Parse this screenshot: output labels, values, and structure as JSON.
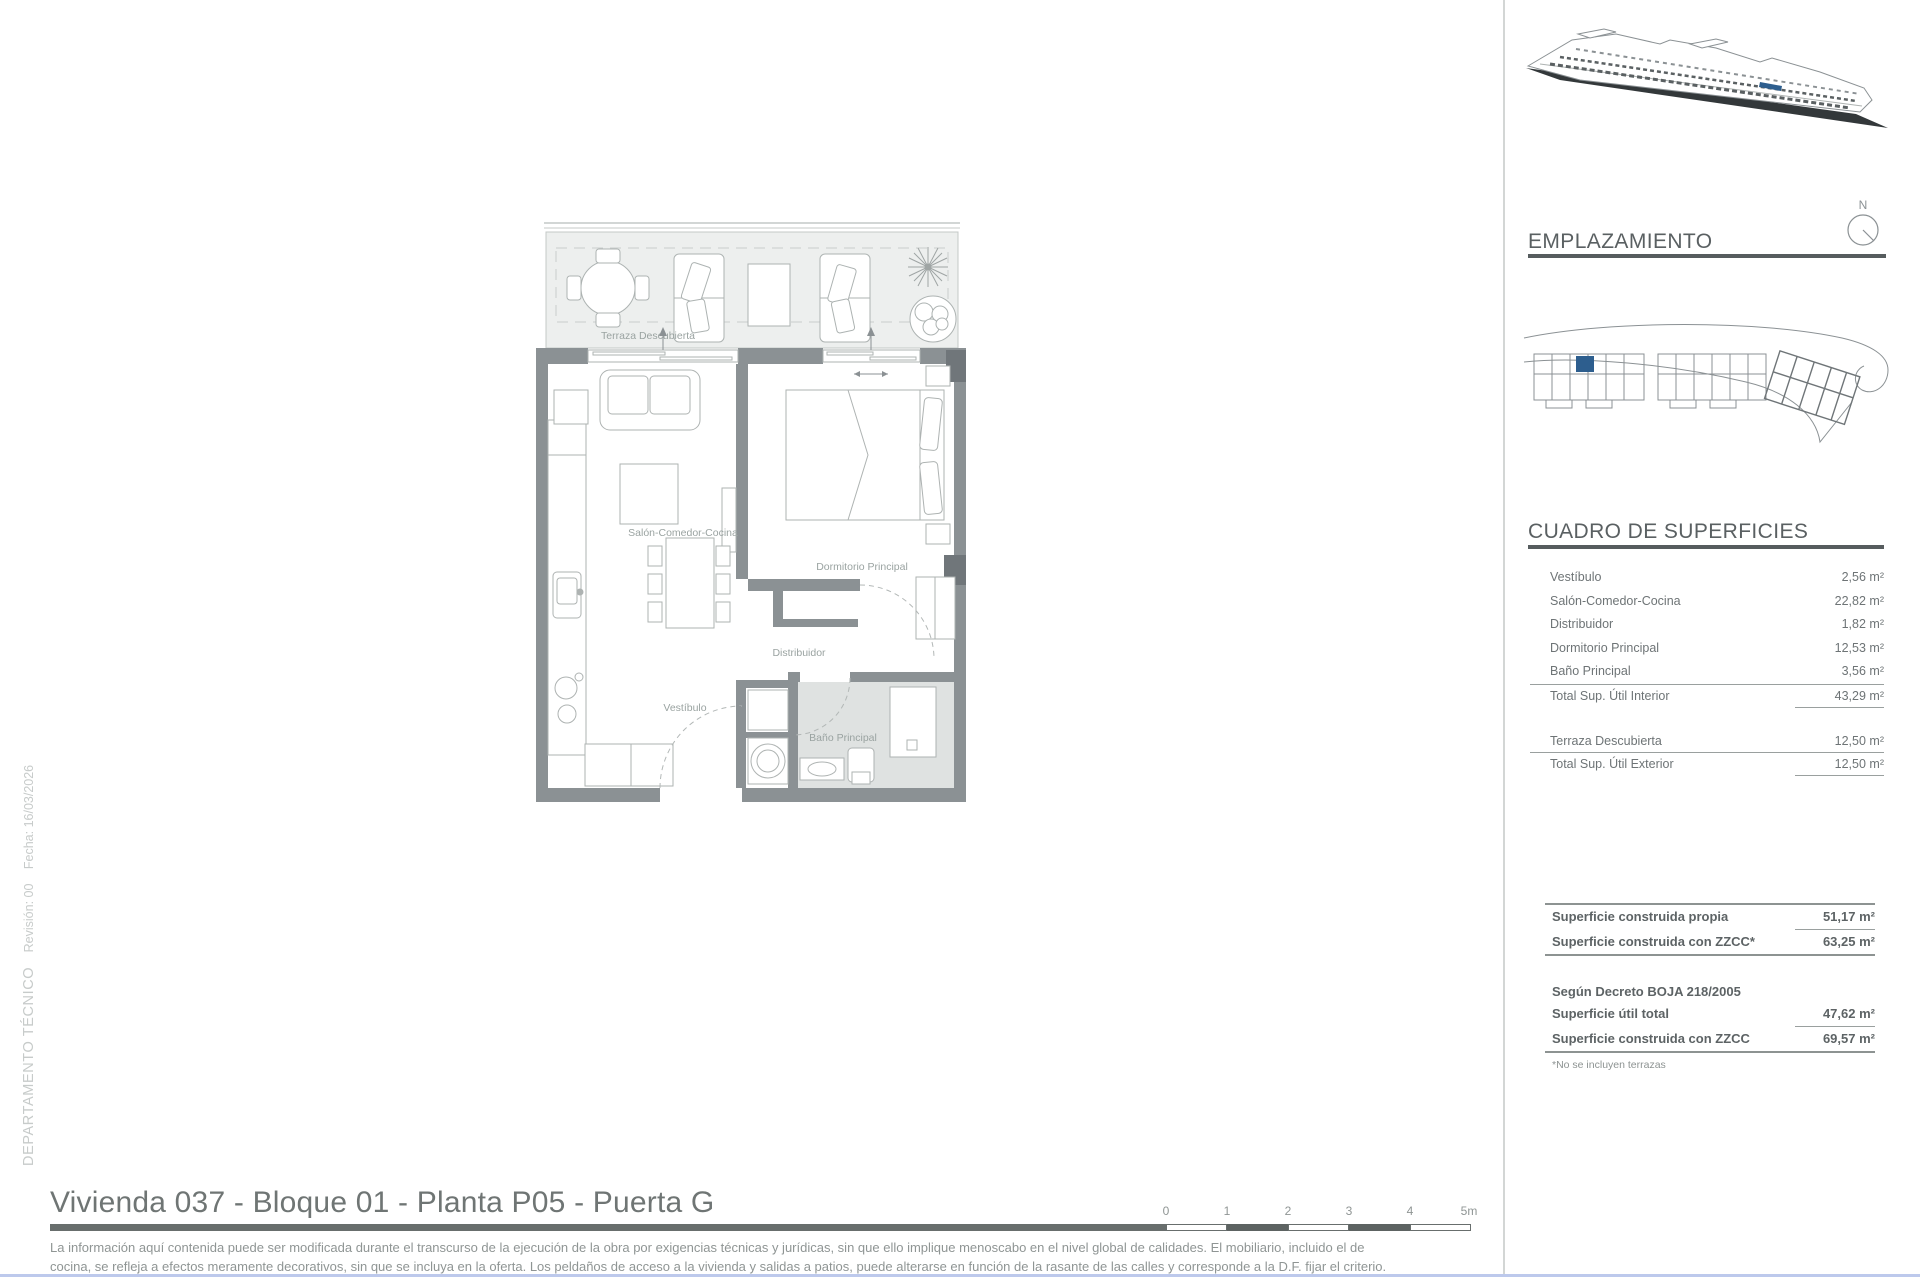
{
  "document": {
    "title": "Vivienda 037 - Bloque 01 - Planta P05 - Puerta G",
    "disclaimer": {
      "line1": "La información aquí contenida puede ser modificada durante el transcurso de la ejecución de la obra por exigencias técnicas y jurídicas, sin que ello implique menoscabo en el nivel global de calidades. El mobiliario, incluido el de",
      "line2": "cocina, se refleja a efectos meramente decorativos, sin que se incluya en la oferta. Los peldaños de acceso a la vivienda y salidas a patios, puede alterarse en función de la rasante de las calles y corresponde a la D.F. fijar el criterio."
    },
    "stamp": {
      "department": "DEPARTAMENTO TÉCNICO",
      "revision": "Revisión: 00",
      "date": "Fecha: 16/03/2026"
    }
  },
  "plan": {
    "room_labels": {
      "terraza": "Terraza Descubierta",
      "salon": "Salón-Comedor-Cocina",
      "dormitorio": "Dormitorio Principal",
      "distribuidor": "Distribuidor",
      "vestibulo": "Vestíbulo",
      "bano": "Baño Principal"
    },
    "wall_color": "#8b9194",
    "terrace_fill": "#edefee",
    "bath_fill": "#dfe2e1"
  },
  "scale_bar": {
    "labels": [
      "0",
      "1",
      "2",
      "3",
      "4",
      "5m"
    ]
  },
  "sidebar": {
    "emplazamiento": {
      "heading": "EMPLAZAMIENTO",
      "compass": "N",
      "unit_marker_color": "#2d5e8e"
    },
    "superficies": {
      "heading": "CUADRO DE SUPERFICIES",
      "interior_rows": [
        {
          "label": "Vestíbulo",
          "value": "2,56 m²"
        },
        {
          "label": "Salón-Comedor-Cocina",
          "value": "22,82 m²"
        },
        {
          "label": "Distribuidor",
          "value": "1,82 m²"
        },
        {
          "label": "Dormitorio Principal",
          "value": "12,53 m²"
        },
        {
          "label": "Baño Principal",
          "value": "3,56 m²"
        }
      ],
      "total_interior": {
        "label": "Total Sup. Útil Interior",
        "value": "43,29 m²"
      },
      "exterior_rows": [
        {
          "label": "Terraza Descubierta",
          "value": "12,50 m²"
        }
      ],
      "total_exterior": {
        "label": "Total Sup. Útil Exterior",
        "value": "12,50 m²"
      }
    },
    "summary": {
      "rows_top": [
        {
          "label": "Superficie construida propia",
          "value": "51,17 m²"
        },
        {
          "label": "Superficie construida con ZZCC*",
          "value": "63,25 m²"
        }
      ],
      "decree_heading": "Según Decreto BOJA 218/2005",
      "rows_decree": [
        {
          "label": "Superficie útil total",
          "value": "47,62 m²"
        },
        {
          "label": "Superficie construida con ZZCC",
          "value": "69,57 m²"
        }
      ],
      "footnote": "*No se incluyen terrazas"
    }
  }
}
